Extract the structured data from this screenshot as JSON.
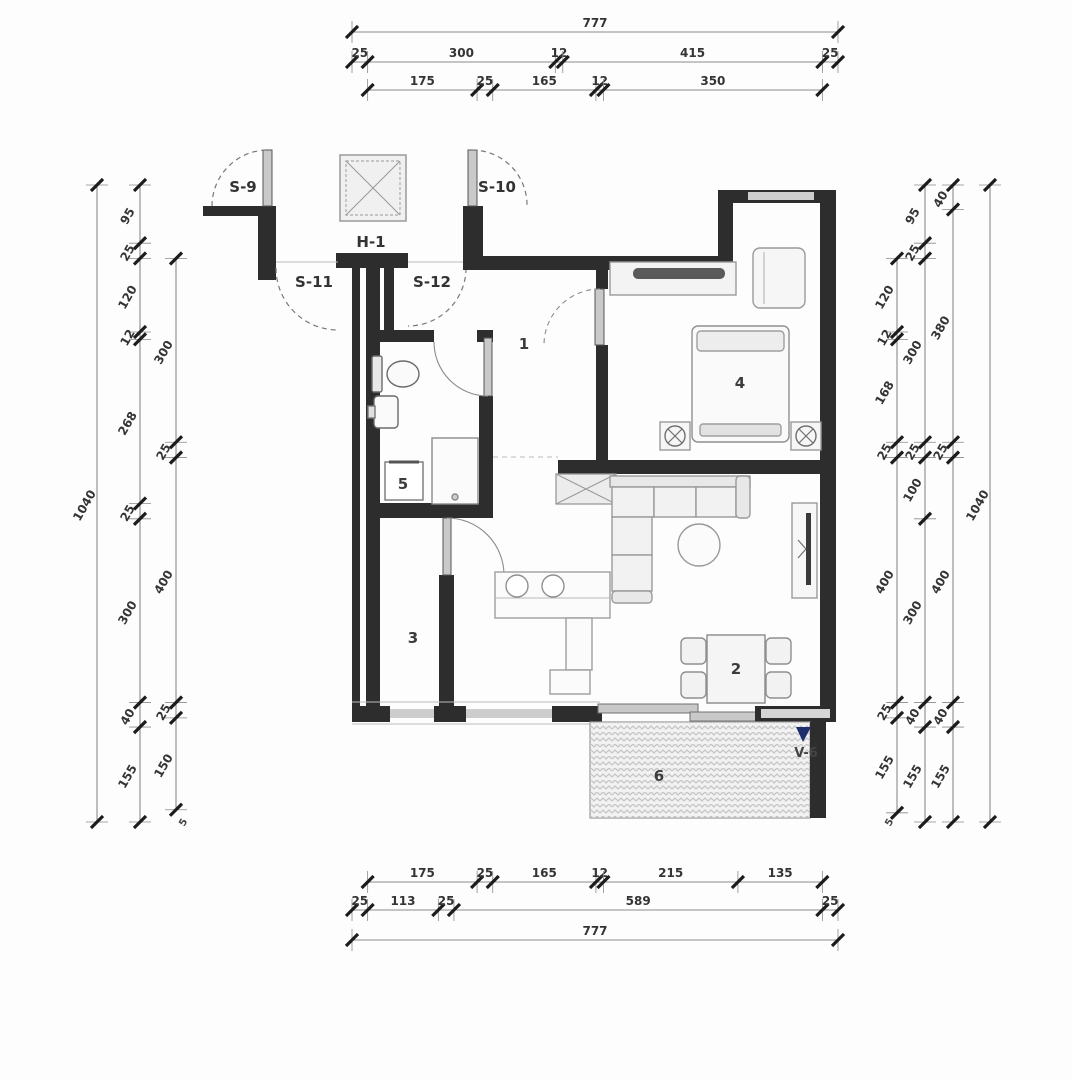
{
  "drawing": {
    "type": "apartment floor plan",
    "rooms": [
      {
        "number": "1"
      },
      {
        "number": "2"
      },
      {
        "number": "3"
      },
      {
        "number": "4"
      },
      {
        "number": "5"
      },
      {
        "number": "6"
      }
    ],
    "door_labels": {
      "s9": "S-9",
      "s10": "S-10",
      "s11": "S-11",
      "s12": "S-12"
    },
    "column_label": "H-1",
    "terrace_marker_label": "V-6",
    "dimensions": {
      "top": [
        {
          "id": "t1",
          "values": [
            "777"
          ]
        },
        {
          "id": "t2",
          "values": [
            "25",
            "300",
            "12",
            "415",
            "25"
          ]
        },
        {
          "id": "t3",
          "values": [
            "175",
            "25",
            "165",
            "12",
            "350"
          ]
        }
      ],
      "bottom": [
        {
          "id": "b1",
          "values": [
            "175",
            "25",
            "165",
            "12",
            "215",
            "135"
          ]
        },
        {
          "id": "b2",
          "values": [
            "25",
            "113",
            "25",
            "589",
            "25"
          ]
        },
        {
          "id": "b3",
          "values": [
            "777"
          ]
        }
      ],
      "left": [
        {
          "id": "l1",
          "values": [
            "1040"
          ]
        },
        {
          "id": "l2",
          "values": [
            "95",
            "25",
            "120",
            "12",
            "268",
            "25",
            "300",
            "40",
            "155"
          ]
        },
        {
          "id": "l3",
          "values": [
            "300",
            "25",
            "400",
            "25",
            "150"
          ]
        }
      ],
      "right": [
        {
          "id": "r1",
          "values": [
            "120",
            "12",
            "168",
            "25",
            "400",
            "25",
            "155"
          ]
        },
        {
          "id": "r2",
          "values": [
            "95",
            "25",
            "300",
            "25",
            "100",
            "300",
            "40",
            "155"
          ]
        },
        {
          "id": "r3",
          "values": [
            "40",
            "380",
            "25",
            "400",
            "40",
            "155"
          ]
        },
        {
          "id": "r4",
          "values": [
            "1040"
          ]
        }
      ]
    },
    "extra_marks": {
      "left_bottom": "5",
      "right_bottom": "5"
    },
    "colors": {
      "wall": "#2d2d2d",
      "window": "#cdcdcd",
      "dim_line": "#8a8a8a",
      "tick": "#1c1c1c",
      "text": "#3a3a3a",
      "marker_blue": "#1d2e6e",
      "hatch": "#c6c6c6",
      "furniture": "#949494"
    }
  }
}
